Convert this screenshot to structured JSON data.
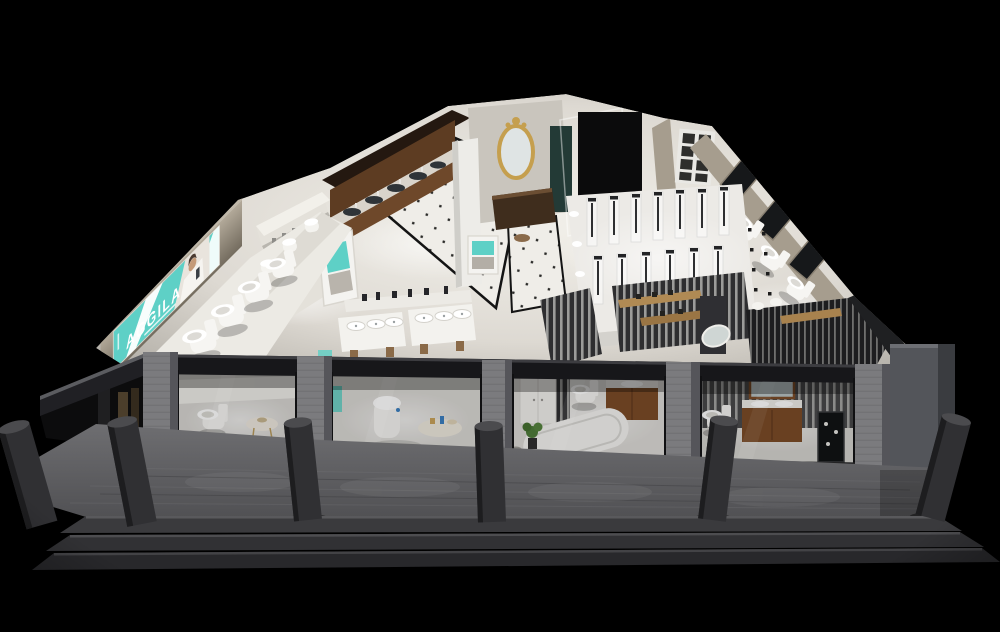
{
  "scene": {
    "type": "3d-showroom-cutaway-render",
    "subject": "bathroom-sanitaryware-showroom",
    "brand": {
      "logo_text": "AGGILA"
    },
    "palette": {
      "background": "#000000",
      "sign_teal": "#5ed0c6",
      "wall_beige": "#a69d8e",
      "wall_beige_dark": "#7e7668",
      "wood_dark": "#5d3c22",
      "wood_counter_front": "#6e482a",
      "wood_vanity": "#7b4a26",
      "marble_light": "#f1efe9",
      "tile_white": "#efede8",
      "walkway_gray": "#646467",
      "step_gray": "#3a3a3d",
      "bollard_gray": "#303033",
      "beam_black": "#17171a",
      "pilaster_gray": "#7b7b7e",
      "column_gray": "#53555a",
      "slat_light": "#9b9b99",
      "slat_dark": "#2e2e30",
      "gold": "#c59f4e",
      "plant_green": "#4e7c3a",
      "porcelain_white": "#f6f5f2"
    },
    "areas": [
      "brand-sign-wall",
      "toilet-display-platform",
      "fixture-display-wall",
      "wood-vanity-counters",
      "tile-aisle",
      "basin-display-tables",
      "luxury-mirror-display",
      "glass-shower-cabin",
      "window-display-room",
      "shower-column-display",
      "slat-partition-lounge",
      "vanity-display-rooms",
      "smart-toilet-room",
      "bathtub-room",
      "storefront-glazing",
      "entry-walkway",
      "front-steps",
      "bollards"
    ]
  }
}
